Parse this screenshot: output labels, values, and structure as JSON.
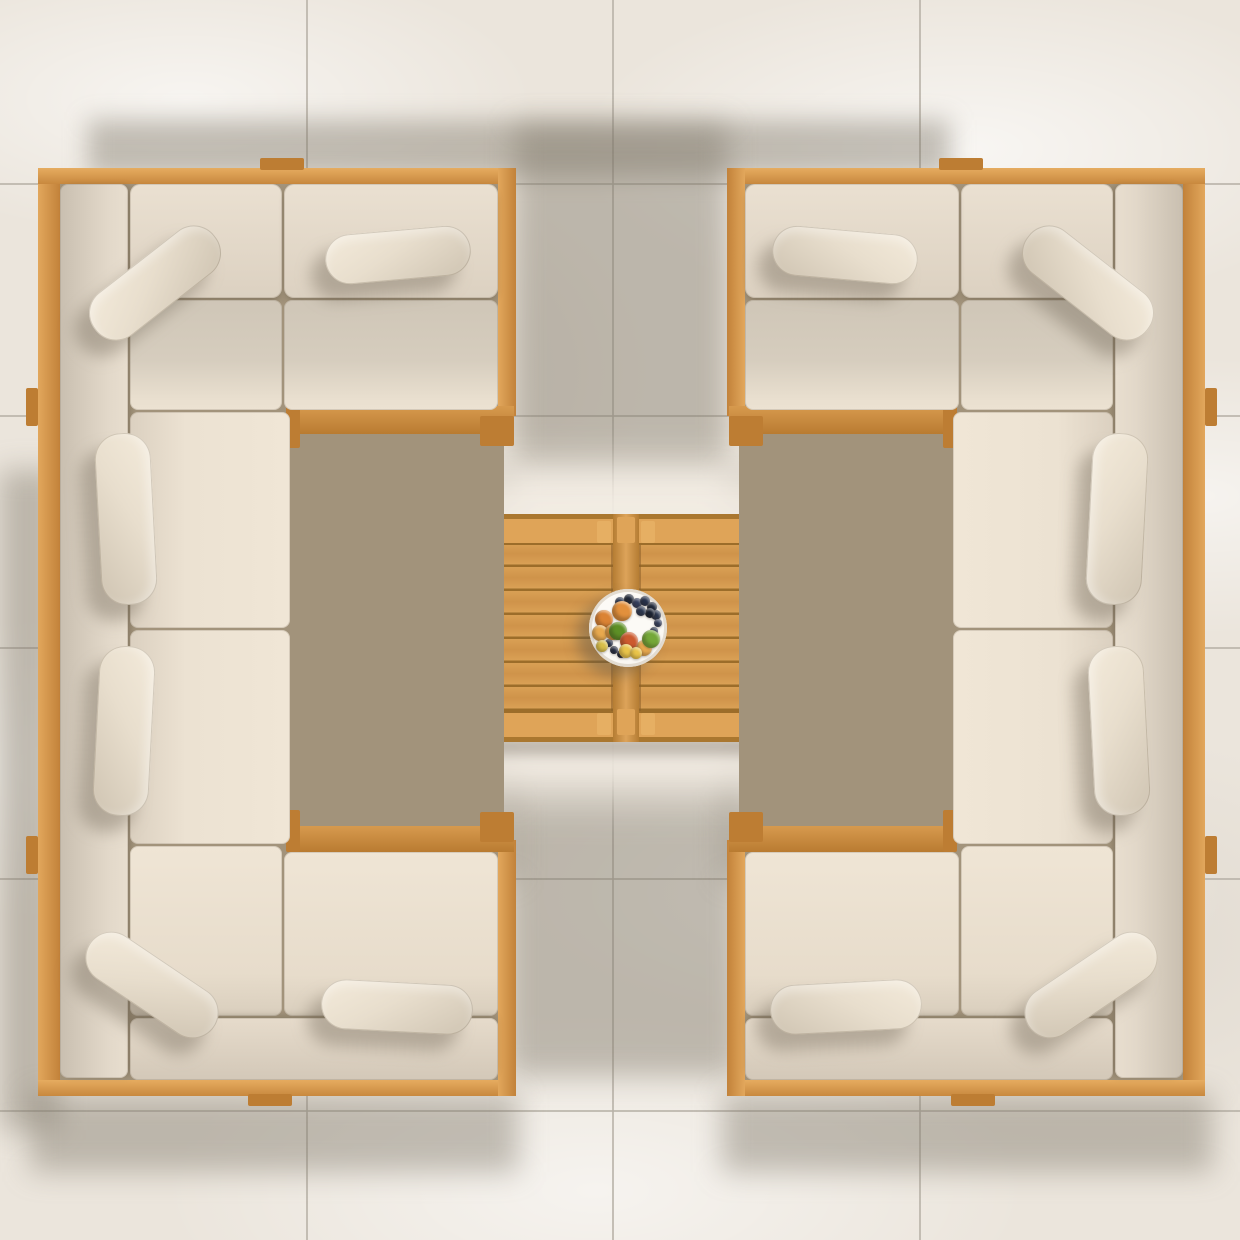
{
  "scene": {
    "description": "Top-down view of a symmetrical outdoor teak lounge set: two C-shaped sectionals with beige cushions facing each other across a twin-top teak coffee table holding a fruit plate, on large cream stone tiles with soft shadows."
  },
  "palette": {
    "floor": "#ebe5dc",
    "grout": "#b8b1a7",
    "shadow": "rgba(125,116,103,0.42)",
    "sun_patch": "#f2ece3",
    "underlay": "#a2937b",
    "tab_wood": "#bd7d33"
  },
  "floor": {
    "grout_x": [
      306,
      612,
      919
    ],
    "grout_y": [
      183,
      415,
      647,
      878,
      1110
    ],
    "grout_w": 2
  },
  "shadows": [
    {
      "x": 88,
      "y": 120,
      "w": 862,
      "h": 56,
      "blur": 12,
      "shape": "rect"
    },
    {
      "x": 515,
      "y": 124,
      "w": 212,
      "h": 352,
      "blur": 14,
      "shape": "rect"
    },
    {
      "x": 350,
      "y": 470,
      "w": 166,
      "h": 215,
      "blur": 12,
      "shape": "rect"
    },
    {
      "x": 348,
      "y": 565,
      "w": 170,
      "h": 240,
      "blur": 12,
      "shape": "bl"
    },
    {
      "x": 724,
      "y": 470,
      "w": 166,
      "h": 215,
      "blur": 12,
      "shape": "rect"
    },
    {
      "x": 722,
      "y": 565,
      "w": 170,
      "h": 240,
      "blur": 12,
      "shape": "br"
    },
    {
      "x": 508,
      "y": 764,
      "w": 230,
      "h": 312,
      "blur": 14,
      "shape": "rect"
    },
    {
      "x": 298,
      "y": 792,
      "w": 218,
      "h": 88,
      "blur": 14,
      "shape": "rect"
    },
    {
      "x": 724,
      "y": 792,
      "w": 218,
      "h": 88,
      "blur": 14,
      "shape": "rect"
    },
    {
      "x": 0,
      "y": 470,
      "w": 58,
      "h": 660,
      "blur": 14,
      "shape": "rect"
    },
    {
      "x": 30,
      "y": 1094,
      "w": 488,
      "h": 78,
      "blur": 14,
      "shape": "rect"
    },
    {
      "x": 722,
      "y": 1094,
      "w": 490,
      "h": 78,
      "blur": 14,
      "shape": "rect"
    }
  ],
  "sun_patch": {
    "x": 366,
    "y": 466,
    "w": 516,
    "h": 330,
    "blur": 22,
    "opacity": 0.95
  },
  "table": {
    "contact_shadows": [
      [
        422,
        520,
        20,
        224
      ],
      [
        428,
        738,
        386,
        16
      ]
    ],
    "base": {
      "x": 438,
      "y": 514,
      "w": 377,
      "h": 228
    },
    "halves": [
      {
        "x": 443,
        "y": 519,
        "w": 170,
        "h": 218
      },
      {
        "x": 639,
        "y": 519,
        "w": 170,
        "h": 218
      }
    ],
    "divider": {
      "x": 613,
      "y": 514,
      "w": 26,
      "h": 228
    },
    "divider_blocks": [
      [
        617,
        517,
        18,
        26
      ],
      [
        617,
        709,
        18,
        26
      ]
    ],
    "band_h": 26,
    "plank_pitch": 24,
    "colors": {
      "base": "#aa772f",
      "plank": "#d9a055",
      "plank_mid": "#cf934a",
      "groove": "#9c6d2a",
      "band": "#dfa458",
      "leg": "#e6af63",
      "divider": "#b57d33",
      "divider_hi": "#dda35a",
      "contact_shadow": "rgba(110,100,86,0.45)"
    }
  },
  "plate": {
    "cx": 628,
    "cy": 628,
    "r": 39,
    "fill": "#f7f4ee",
    "rim": "#e0d9cc"
  },
  "fruits": [
    {
      "dx": -8,
      "dy": -26,
      "r": 5,
      "c": "#2b3750"
    },
    {
      "dx": 1,
      "dy": -29,
      "r": 5,
      "c": "#1f2839"
    },
    {
      "dx": 9,
      "dy": -25,
      "r": 5,
      "c": "#343f5e"
    },
    {
      "dx": 17,
      "dy": -27,
      "r": 5,
      "c": "#27324c"
    },
    {
      "dx": 24,
      "dy": -21,
      "r": 5,
      "c": "#1f2839"
    },
    {
      "dx": 28,
      "dy": -13,
      "r": 5,
      "c": "#2b3750"
    },
    {
      "dx": 30,
      "dy": -5,
      "r": 4,
      "c": "#343f5e"
    },
    {
      "dx": 22,
      "dy": -15,
      "r": 5,
      "c": "#1a2233"
    },
    {
      "dx": 13,
      "dy": -17,
      "r": 5,
      "c": "#2b3750"
    },
    {
      "dx": 26,
      "dy": 3,
      "r": 4,
      "c": "#27324c"
    },
    {
      "dx": -14,
      "dy": 22,
      "r": 4,
      "c": "#232c42"
    },
    {
      "dx": -19,
      "dy": 15,
      "r": 4,
      "c": "#2b3750"
    },
    {
      "dx": -7,
      "dy": 26,
      "r": 4,
      "c": "#1f2839"
    },
    {
      "dx": -6,
      "dy": -17,
      "r": 10,
      "c": "#e2903c"
    },
    {
      "dx": -24,
      "dy": -9,
      "r": 9,
      "c": "#db8334"
    },
    {
      "dx": -28,
      "dy": 5,
      "r": 8,
      "c": "#e8a94e"
    },
    {
      "dx": -15,
      "dy": 4,
      "r": 8,
      "c": "#df9a42"
    },
    {
      "dx": 16,
      "dy": 20,
      "r": 8,
      "c": "#e8a94e"
    },
    {
      "dx": -10,
      "dy": 3,
      "r": 9,
      "c": "#5d8f26"
    },
    {
      "dx": 23,
      "dy": 11,
      "r": 9,
      "c": "#74a838"
    },
    {
      "dx": 1,
      "dy": 13,
      "r": 9,
      "c": "#cc5a2f"
    },
    {
      "dx": -2,
      "dy": 23,
      "r": 7,
      "c": "#e9c44a"
    },
    {
      "dx": 8,
      "dy": 25,
      "r": 6,
      "c": "#e9c44a"
    },
    {
      "dx": -26,
      "dy": 18,
      "r": 6,
      "c": "#d8bf4a"
    }
  ],
  "sofa_template": {
    "underlay": {
      "x": 56,
      "y": 180,
      "w": 448,
      "h": 902
    },
    "wood": [
      {
        "n": "left-outer-rail",
        "x": 38,
        "y": 168,
        "w": 22,
        "h": 928,
        "f": {
          "lg": [
            90,
            [
              "#e2a75c",
              0
            ],
            [
              "#c2823a",
              100
            ]
          ]
        }
      },
      {
        "n": "top-outer-rail",
        "x": 38,
        "y": 168,
        "w": 478,
        "h": 16,
        "f": {
          "lg": [
            180,
            [
              "#e6ac60",
              0
            ],
            [
              "#c8883e",
              100
            ]
          ]
        }
      },
      {
        "n": "bottom-outer-rail",
        "x": 38,
        "y": 1080,
        "w": 478,
        "h": 16,
        "f": {
          "lg": [
            180,
            [
              "#e6ac60",
              0
            ],
            [
              "#c8883e",
              100
            ]
          ]
        }
      },
      {
        "n": "top-arm-end-rail",
        "x": 498,
        "y": 168,
        "w": 18,
        "h": 248,
        "f": {
          "lg": [
            90,
            [
              "#e2a75c",
              0
            ],
            [
              "#c2823a",
              100
            ]
          ]
        }
      },
      {
        "n": "bottom-arm-end-rail",
        "x": 498,
        "y": 840,
        "w": 18,
        "h": 256,
        "f": {
          "lg": [
            90,
            [
              "#e2a75c",
              0
            ],
            [
              "#c2823a",
              100
            ]
          ]
        }
      },
      {
        "n": "top-arm-inner-rail",
        "x": 298,
        "y": 406,
        "w": 216,
        "h": 28,
        "f": {
          "lg": [
            180,
            [
              "#d79a4e",
              0
            ],
            [
              "#b97b31",
              100
            ]
          ]
        }
      },
      {
        "n": "bottom-arm-inner-rail",
        "x": 298,
        "y": 826,
        "w": 216,
        "h": 26,
        "f": {
          "lg": [
            180,
            [
              "#d79a4e",
              0
            ],
            [
              "#b97b31",
              100
            ]
          ]
        }
      }
    ],
    "tabs": [
      [
        286,
        406,
        14,
        42
      ],
      [
        480,
        416,
        34,
        30
      ],
      [
        286,
        810,
        14,
        42
      ],
      [
        480,
        812,
        34,
        30
      ],
      [
        260,
        158,
        44,
        12
      ],
      [
        248,
        1094,
        44,
        12
      ],
      [
        26,
        388,
        12,
        38
      ],
      [
        26,
        836,
        12,
        38
      ]
    ],
    "cushions": [
      {
        "n": "spine-back-cushion",
        "x": 60,
        "y": 184,
        "w": 68,
        "h": 894,
        "r": 8,
        "f": {
          "lg": [
            90,
            [
              "#c9bfb0",
              0
            ],
            [
              "#e2d8c9",
              70
            ],
            [
              "#e8decf",
              100
            ]
          ]
        },
        "cs": [
          4,
          0,
          7,
          -2,
          "rgba(90,80,62,0.40)"
        ]
      },
      {
        "n": "corner-back-cushion",
        "x": 130,
        "y": 184,
        "w": 152,
        "h": 114,
        "r": 10,
        "f": {
          "lg": [
            180,
            [
              "#eae0d1",
              0
            ],
            [
              "#dcd1c1",
              100
            ]
          ]
        },
        "cs": [
          0,
          4,
          7,
          -2,
          "rgba(90,80,62,0.45)"
        ]
      },
      {
        "n": "arm-back-cushion",
        "x": 284,
        "y": 184,
        "w": 214,
        "h": 114,
        "r": 10,
        "f": {
          "lg": [
            180,
            [
              "#eae0d1",
              0
            ],
            [
              "#dcd1c1",
              100
            ]
          ]
        },
        "cs": [
          0,
          4,
          7,
          -2,
          "rgba(90,80,62,0.45)"
        ]
      },
      {
        "n": "corner-seat-cushion",
        "x": 130,
        "y": 300,
        "w": 152,
        "h": 110,
        "r": 8,
        "f": {
          "lg": [
            180,
            [
              "#cfc6b7",
              0
            ],
            [
              "#d6cdbe",
              55
            ],
            [
              "#e9dfcf",
              90
            ],
            [
              "#ece2d2",
              100
            ]
          ]
        }
      },
      {
        "n": "arm-seat-cushion",
        "x": 284,
        "y": 300,
        "w": 214,
        "h": 110,
        "r": 8,
        "f": {
          "lg": [
            180,
            [
              "#cfc6b7",
              0
            ],
            [
              "#d6cdbe",
              55
            ],
            [
              "#e9dfcf",
              90
            ],
            [
              "#ece2d2",
              100
            ]
          ]
        }
      },
      {
        "n": "spine-seat-cushion",
        "x": 130,
        "y": 412,
        "w": 160,
        "h": 216,
        "r": 8,
        "f": {
          "lg": [
            90,
            [
              "#dbd0c0",
              0
            ],
            [
              "#ece2d2",
              35
            ],
            [
              "#f0e6d6",
              100
            ]
          ]
        }
      },
      {
        "n": "spine-seat-cushion",
        "x": 130,
        "y": 630,
        "w": 160,
        "h": 214,
        "r": 8,
        "f": {
          "lg": [
            90,
            [
              "#dbd0c0",
              0
            ],
            [
              "#ece2d2",
              35
            ],
            [
              "#f0e6d6",
              100
            ]
          ]
        }
      },
      {
        "n": "corner-seat-cushion",
        "x": 130,
        "y": 846,
        "w": 152,
        "h": 170,
        "r": 8,
        "f": {
          "lg": [
            180,
            [
              "#efe5d5",
              0
            ],
            [
              "#e7dccb",
              75
            ],
            [
              "#d9cebd",
              100
            ]
          ]
        }
      },
      {
        "n": "arm-seat-cushion",
        "x": 284,
        "y": 852,
        "w": 214,
        "h": 164,
        "r": 8,
        "f": {
          "lg": [
            180,
            [
              "#efe5d5",
              0
            ],
            [
              "#e7dccb",
              75
            ],
            [
              "#d9cebd",
              100
            ]
          ]
        }
      },
      {
        "n": "arm-back-cushion",
        "x": 130,
        "y": 1018,
        "w": 368,
        "h": 62,
        "r": 8,
        "f": {
          "lg": [
            180,
            [
              "#e6dbcb",
              0
            ],
            [
              "#d3c8b8",
              100
            ]
          ]
        },
        "cs": [
          0,
          -4,
          7,
          -2,
          "rgba(90,80,62,0.35)"
        ]
      }
    ],
    "pillow_fill": {
      "lg": [
        150,
        [
          "#f4ebdb",
          0
        ],
        [
          "#e8decd",
          45
        ],
        [
          "#cfc4b2",
          100
        ]
      ]
    },
    "pillow_shadow": {
      "dx": -14,
      "dy": 16,
      "blur": 8,
      "c": "rgba(105,95,80,0.38)"
    },
    "pillows": [
      {
        "n": "corner-lumbar-pillow",
        "cx": 155,
        "cy": 283,
        "w": 152,
        "h": 54,
        "rot": -38
      },
      {
        "n": "arm-lumbar-pillow",
        "cx": 398,
        "cy": 255,
        "w": 146,
        "h": 50,
        "rot": -5
      },
      {
        "n": "spine-lumbar-pillow",
        "cx": 126,
        "cy": 519,
        "w": 172,
        "h": 56,
        "rot": 87
      },
      {
        "n": "spine-lumbar-pillow",
        "cx": 124,
        "cy": 731,
        "w": 170,
        "h": 56,
        "rot": 93
      },
      {
        "n": "corner-lumbar-pillow",
        "cx": 152,
        "cy": 985,
        "w": 150,
        "h": 52,
        "rot": 34
      },
      {
        "n": "arm-lumbar-pillow",
        "cx": 397,
        "cy": 1007,
        "w": 152,
        "h": 50,
        "rot": 3
      }
    ]
  },
  "sofas": [
    {
      "name": "left-sectional",
      "mirror": false,
      "axis": 0
    },
    {
      "name": "right-sectional",
      "mirror": true,
      "axis": 1243
    }
  ]
}
